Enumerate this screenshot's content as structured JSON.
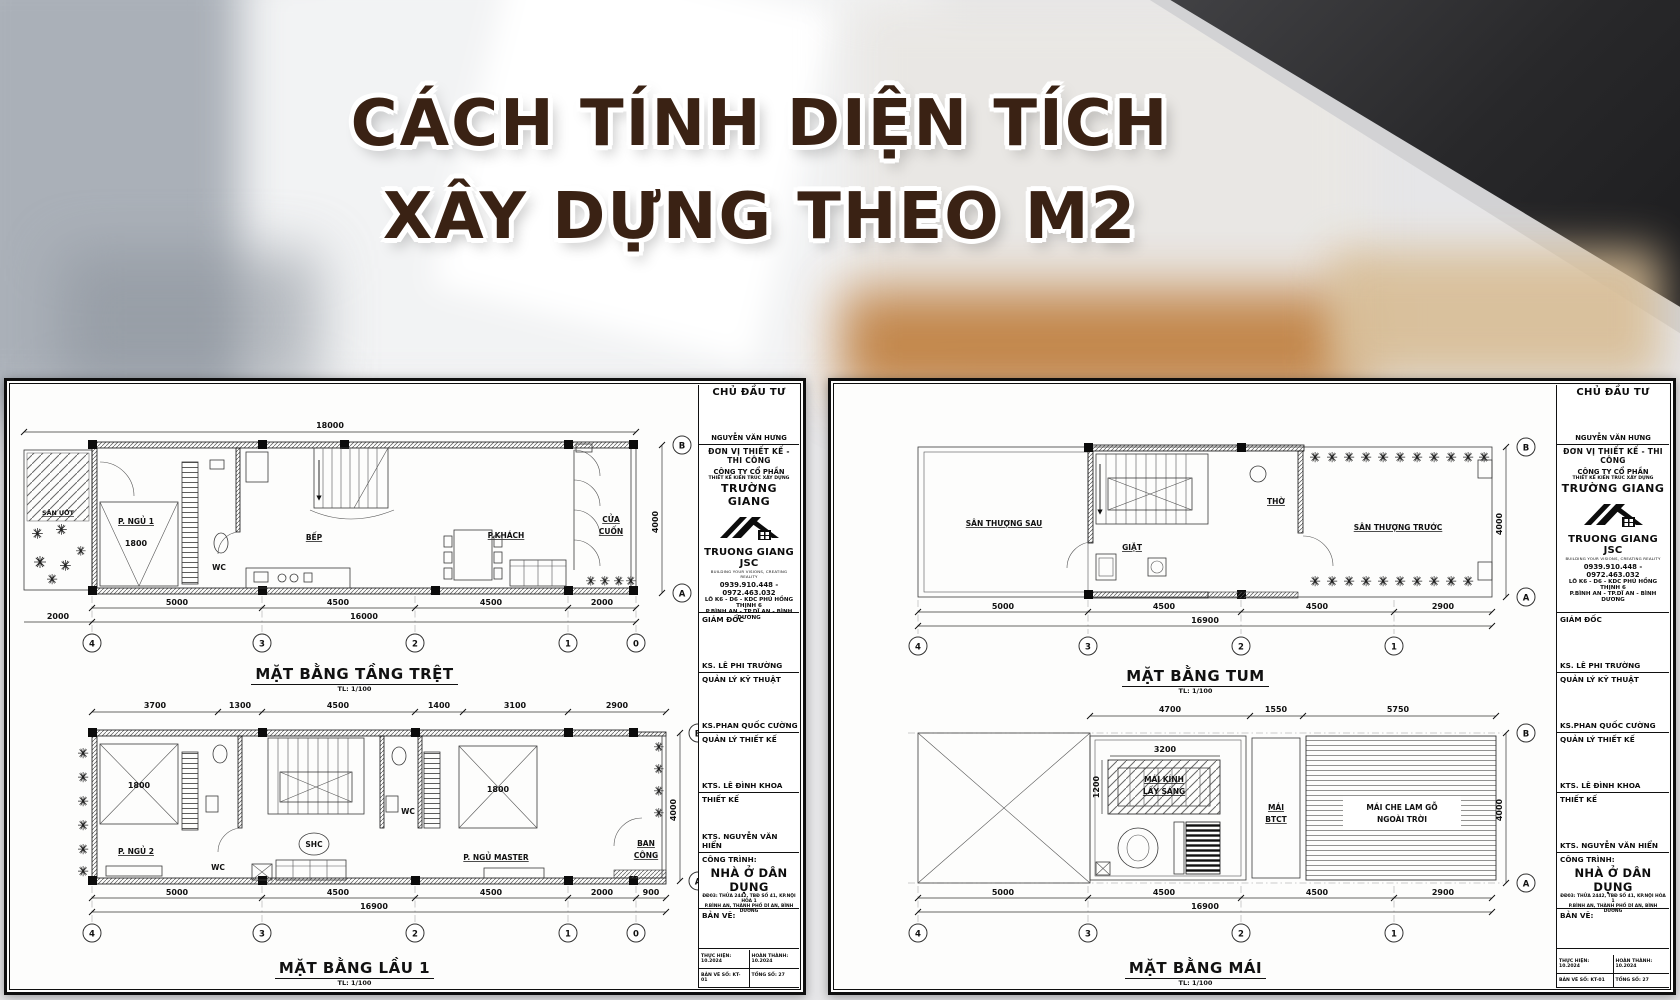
{
  "title": {
    "line1": "CÁCH TÍNH DIỆN TÍCH",
    "line2": "XÂY DỰNG THEO M2"
  },
  "colors": {
    "headline": "#3a2214",
    "accent_orange": "#b96f26",
    "sheet_paper": "#fdfdfc",
    "line_ink": "#111111"
  },
  "title_block": {
    "chu_dau_tu_label": "CHỦ ĐẦU TƯ",
    "chu_dau_tu_name": "NGUYỄN VĂN HƯNG",
    "don_vi_label": "ĐƠN VỊ THIẾT KẾ - THI CÔNG",
    "company_line1": "CÔNG TY CỔ PHẦN",
    "company_line2": "THIẾT KẾ KIẾN TRÚC XÂY DỰNG",
    "company_name": "TRƯỜNG GIANG",
    "company_en": "TRUONG GIANG JSC",
    "tagline": "BUILDING YOUR VISIONS, CREATING REALITY",
    "phone": "0939.910.448 - 0972.463.032",
    "address1": "LÔ K6 - D6 - KDC PHÚ HỒNG THỊNH 6",
    "address2": "P.BÌNH AN - TP.DĨ AN - BÌNH DƯƠNG",
    "roles": [
      {
        "label": "GIÁM ĐỐC",
        "name": "KS. LÊ PHI TRƯỜNG"
      },
      {
        "label": "QUẢN LÝ KỸ THUẬT",
        "name": "KS.PHAN QUỐC CƯỜNG"
      },
      {
        "label": "QUẢN LÝ THIẾT KẾ",
        "name": "KTS. LÊ ĐÌNH KHOA"
      },
      {
        "label": "THIẾT KẾ",
        "name": "KTS. NGUYỄN VĂN HIỂN"
      }
    ],
    "cong_trinh_label": "CÔNG TRÌNH:",
    "project_name": "NHÀ Ở DÂN DỤNG",
    "project_addr1": "ĐĐ03: THỬA 2442, TBĐ SỐ 41, KP.NỘI HÒA 1",
    "project_addr2": "P.BÌNH AN, THÀNH PHỐ DĨ AN, BÌNH DƯƠNG",
    "ban_ve_label": "BẢN VẼ:",
    "thuc_hien": "THỰC HIỆN: 10.2024",
    "hoan_thanh": "HOÀN THÀNH: 10.2024",
    "ban_ve_so": "BẢN VẼ SỐ: KT-01",
    "tong_so": "TỔNG SỐ: 27"
  },
  "plans": {
    "tang_tret": {
      "title": "MẶT BẰNG TẦNG TRỆT",
      "scale": "TL: 1/100",
      "dim_top": "18000",
      "dims_bottom": [
        "5000",
        "4500",
        "4500",
        "2000"
      ],
      "dim_total": "16000",
      "dim_left": "2000",
      "dim_right": "4000",
      "grid_cols": [
        "4",
        "3",
        "2",
        "1",
        "0"
      ],
      "grid_rows": [
        "B",
        "A"
      ],
      "rooms": {
        "san_uot": "SÂN ƯỚT",
        "p_ngu1": "P. NGỦ 1",
        "bed1": "1800",
        "wc": "WC",
        "bep": "BẾP",
        "p_khach": "P.KHÁCH",
        "cua_cuon_1": "CỬA",
        "cua_cuon_2": "CUỐN"
      }
    },
    "lau1": {
      "title": "MẶT BẰNG LẦU 1",
      "scale": "TL: 1/100",
      "dims_top": [
        "3700",
        "1300",
        "4500",
        "1400",
        "3100",
        "2900"
      ],
      "dims_bottom": [
        "5000",
        "4500",
        "4500",
        "2000",
        "900"
      ],
      "dim_total": "16900",
      "dim_right": "4000",
      "grid_cols": [
        "4",
        "3",
        "2",
        "1",
        "0"
      ],
      "grid_rows": [
        "B",
        "A"
      ],
      "rooms": {
        "p_ngu2": "P. NGỦ 2",
        "bed1": "1800",
        "wc1": "WC",
        "shc": "SHC",
        "wc2": "WC",
        "master": "P. NGỦ MASTER",
        "bed2": "1800",
        "ban_cong_1": "BAN",
        "ban_cong_2": "CÔNG"
      }
    },
    "tum": {
      "title": "MẶT BẰNG TUM",
      "scale": "TL: 1/100",
      "dims_bottom": [
        "5000",
        "4500",
        "4500",
        "2900"
      ],
      "dim_total": "16900",
      "dim_right": "4000",
      "grid_cols": [
        "4",
        "3",
        "2",
        "1"
      ],
      "grid_rows": [
        "B",
        "A"
      ],
      "rooms": {
        "san_thuong_sau": "SÂN THƯỢNG SAU",
        "tho": "THỜ",
        "giat": "GIẶT",
        "san_thuong_truoc": "SÂN THƯỢNG TRƯỚC"
      }
    },
    "mai": {
      "title": "MẶT BẰNG MÁI",
      "scale": "TL: 1/100",
      "dims_top": [
        "4700",
        "1550",
        "5750"
      ],
      "dim_sky_w": "3200",
      "dim_sky_h": "1200",
      "dims_bottom": [
        "5000",
        "4500",
        "4500",
        "2900"
      ],
      "dim_total": "16900",
      "dim_right": "4000",
      "grid_cols": [
        "4",
        "3",
        "2",
        "1"
      ],
      "grid_rows": [
        "B",
        "A"
      ],
      "rooms": {
        "mai_kinh_1": "MÁI KÍNH",
        "mai_kinh_2": "LẤY SÁNG",
        "mai_btct_1": "MÁI",
        "mai_btct_2": "BTCT",
        "mai_che_1": "MÁI CHE LAM GỖ",
        "mai_che_2": "NGOÀI TRỜI"
      }
    }
  }
}
